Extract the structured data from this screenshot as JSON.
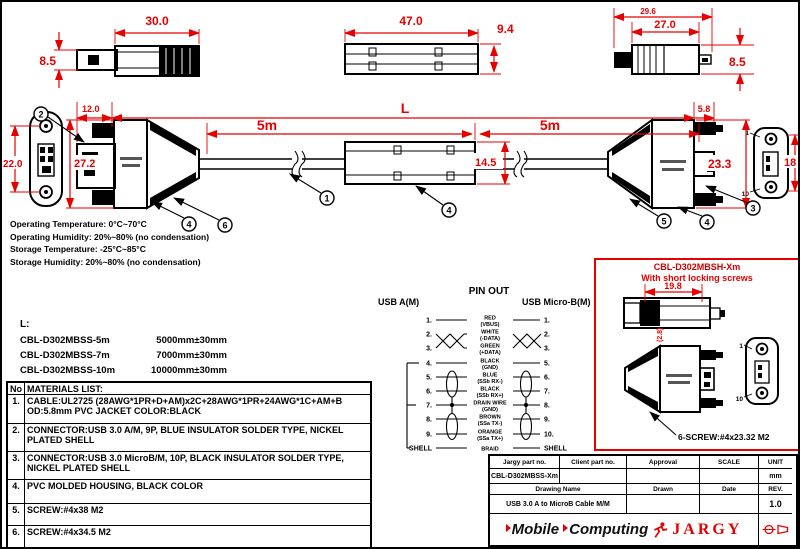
{
  "colors": {
    "dim_red": "#e60000",
    "panel_red": "#cc0000",
    "black": "#000000"
  },
  "views": {
    "usb_a_side": {
      "width": "30.0",
      "height": "8.5"
    },
    "overmold_top": {
      "width": "47.0",
      "height": "9.4"
    },
    "micro_side": {
      "width_outer": "29.6",
      "width_inner": "27.0",
      "height": "8.5"
    }
  },
  "assembly": {
    "front_height": "22.0",
    "offset": "12.0",
    "housing_height": "27.2",
    "total_label": "L",
    "left_length": "5m",
    "right_length": "5m",
    "end_offset": "5.8",
    "ferrite_height": "14.5",
    "micro_height": "23.3",
    "micro_front_height": "18",
    "micro_pin_top": "1",
    "micro_pin_bottom": "10"
  },
  "callouts": {
    "n1": "1",
    "n2": "2",
    "n3": "3",
    "n4": "4",
    "n5": "5",
    "n6": "6"
  },
  "env_notes": [
    "Operating Temperature: 0°C~70°C",
    "Operating Humidity: 20%~80% (no condensation)",
    "Storage Temperature: -25°C~85°C",
    "Storage  Humidity: 20%~80% (no condensation)"
  ],
  "length_list": {
    "label": "L:",
    "rows": [
      {
        "part": "CBL-D302MBSS-5m",
        "value": "5000mm±30mm"
      },
      {
        "part": "CBL-D302MBSS-7m",
        "value": "7000mm±30mm"
      },
      {
        "part": "CBL-D302MBSS-10m",
        "value": "10000mm±30mm"
      }
    ]
  },
  "materials": {
    "col_no": "No",
    "title": "MATERIALS LIST:",
    "rows": [
      {
        "no": "1.",
        "desc": "CABLE:UL2725 (28AWG*1PR+D+AM)x2C+28AWG*1PR+24AWG*1C+AM+B OD:5.8mm  PVC JACKET COLOR:BLACK"
      },
      {
        "no": "2.",
        "desc": "CONNECTOR:USB 3.0 A/M, 9P, BLUE INSULATOR SOLDER TYPE, NICKEL PLATED SHELL"
      },
      {
        "no": "3.",
        "desc": "CONNECTOR:USB 3.0 MicroB/M, 10P, BLACK INSULATOR SOLDER TYPE, NICKEL PLATED SHELL"
      },
      {
        "no": "4.",
        "desc": "PVC MOLDED HOUSING, BLACK COLOR"
      },
      {
        "no": "5.",
        "desc": "SCREW:#4x38 M2"
      },
      {
        "no": "6.",
        "desc": "SCREW:#4x34.5 M2"
      }
    ]
  },
  "pinout": {
    "title": "PIN OUT",
    "left_header": "USB A(M)",
    "right_header": "USB Micro-B(M)",
    "rows": [
      {
        "left": "1.",
        "wire": "RED",
        "sig": "(VBUS)",
        "right": "1."
      },
      {
        "left": "2.",
        "wire": "WHITE",
        "sig": "(-DATA)",
        "right": "2."
      },
      {
        "left": "3.",
        "wire": "GREEN",
        "sig": "(+DATA)",
        "right": "3."
      },
      {
        "left": "4.",
        "wire": "BLACK",
        "sig": "(GND)",
        "right": "5."
      },
      {
        "left": "5.",
        "wire": "BLUE",
        "sig": "(SSb RX-)",
        "right": "6."
      },
      {
        "left": "6.",
        "wire": "BLACK",
        "sig": "(SSb RX+)",
        "right": "7."
      },
      {
        "left": "7.",
        "wire": "DRAIN WIRE",
        "sig": "(GND)",
        "right": "8."
      },
      {
        "left": "8.",
        "wire": "BROWN",
        "sig": "(SSa TX-)",
        "right": "9."
      },
      {
        "left": "9.",
        "wire": "ORANGE",
        "sig": "(SSa TX+)",
        "right": "10."
      },
      {
        "left": "SHELL",
        "wire": "BRAID",
        "sig": "",
        "right": "SHELL"
      }
    ]
  },
  "short_panel": {
    "part": "CBL-D302MBSH-Xm",
    "note": "With short locking screws",
    "dim_width": "19.8",
    "dim_depth": "(2.8)",
    "screw": "6-SCREW:#4x23.32 M2",
    "pin_top": "1",
    "pin_bottom": "10"
  },
  "title_block": {
    "headers": {
      "jargy": "Jargy part no.",
      "client": "Client part no.",
      "approval": "Approval",
      "scale": "SCALE",
      "unit": "UNIT",
      "drawing": "Drawing Name",
      "drawn": "Drawn",
      "date": "Date",
      "rev": "REV."
    },
    "part_no": "CBL-D302MBSS-Xm",
    "unit_value": "mm",
    "drawing_name": "USB 3.0 A to MicroB Cable M/M",
    "rev_value": "1.0",
    "brand_left": "Mobile",
    "brand_mid": "Computing",
    "brand_right": "JARGY"
  }
}
